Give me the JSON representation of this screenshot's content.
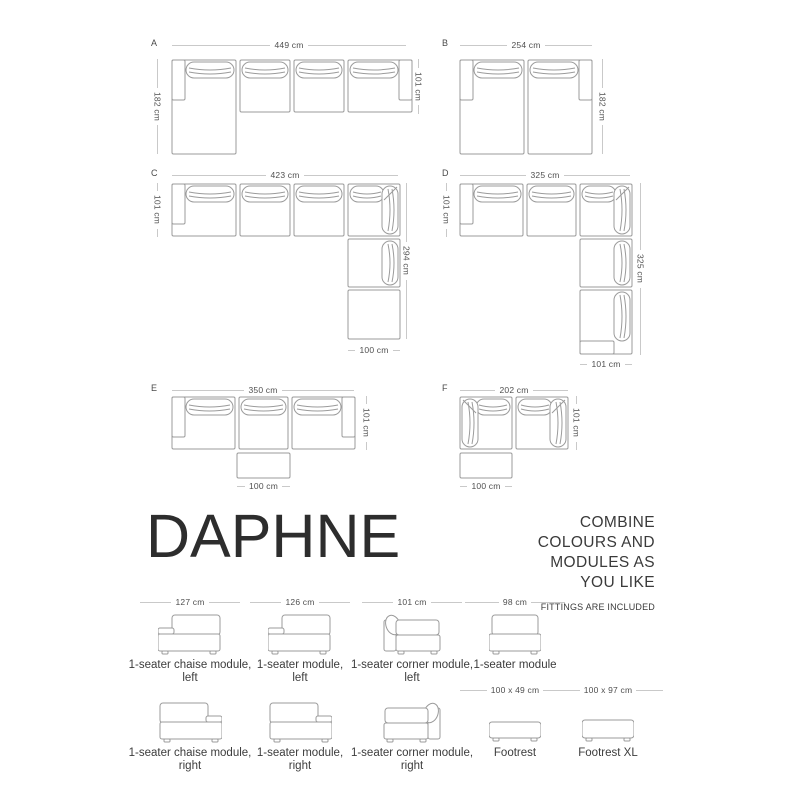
{
  "title": "DAPHNE",
  "tagline": [
    "COMBINE",
    "COLOURS AND",
    "MODULES AS",
    "YOU LIKE"
  ],
  "note": "FITTINGS ARE INCLUDED",
  "configs": [
    {
      "letter": "A",
      "top": "449 cm",
      "left": "182 cm",
      "right": "101 cm"
    },
    {
      "letter": "B",
      "top": "254 cm",
      "right": "182 cm"
    },
    {
      "letter": "C",
      "top": "423 cm",
      "left": "101 cm",
      "right": "294 cm",
      "bottom": "100 cm"
    },
    {
      "letter": "D",
      "top": "325 cm",
      "left": "101 cm",
      "right": "325 cm",
      "bottom": "101 cm"
    },
    {
      "letter": "E",
      "top": "350 cm",
      "right": "101 cm",
      "bottom": "100 cm"
    },
    {
      "letter": "F",
      "top": "202 cm",
      "right": "101 cm",
      "bottom": "100 cm"
    }
  ],
  "modules_row1": [
    {
      "dim": "127 cm",
      "line1": "1-seater chaise module,",
      "line2": "left"
    },
    {
      "dim": "126 cm",
      "line1": "1-seater module,",
      "line2": "left"
    },
    {
      "dim": "101 cm",
      "line1": "1-seater corner module,",
      "line2": "left"
    },
    {
      "dim": "98 cm",
      "line1": "1-seater module"
    }
  ],
  "modules_row2": [
    {
      "line1": "1-seater chaise module,",
      "line2": "right"
    },
    {
      "line1": "1-seater module,",
      "line2": "right"
    },
    {
      "line1": "1-seater corner module,",
      "line2": "right"
    },
    {
      "dim": "100 x 49 cm",
      "line1": "Footrest"
    },
    {
      "dim": "100 x 97 cm",
      "line1": "Footrest XL"
    }
  ],
  "colors": {
    "outline": "#9b9b9b",
    "dim_line": "#c9c9c9",
    "dim_text": "#4f4f4f",
    "caption_text": "#3c3c3c",
    "title_text": "#2d2d2d"
  }
}
